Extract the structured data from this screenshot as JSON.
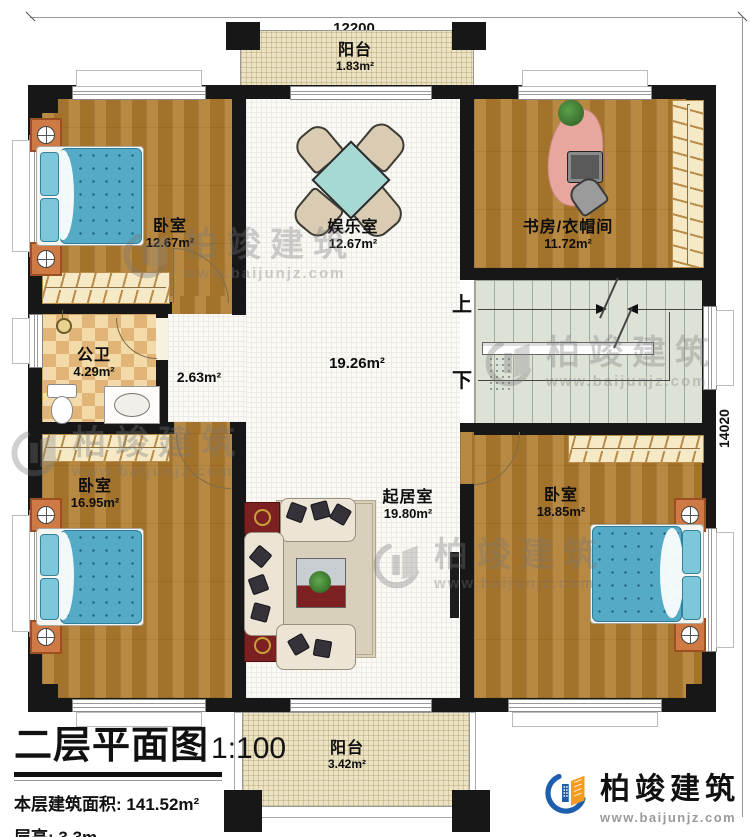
{
  "dimensions": {
    "top": "12200",
    "right": "14020"
  },
  "rooms": {
    "balcony_top": {
      "name": "阳台",
      "area": "1.83m²"
    },
    "bedroom_tl": {
      "name": "卧室",
      "area": "12.67m²"
    },
    "entertainment": {
      "name": "娱乐室",
      "area": "12.67m²"
    },
    "study": {
      "name": "书房/衣帽间",
      "area": "11.72m²"
    },
    "bathroom": {
      "name": "公卫",
      "area": "4.29m²"
    },
    "corridor": {
      "area": "2.63m²"
    },
    "hall": {
      "area": "19.26m²"
    },
    "bedroom_bl": {
      "name": "卧室",
      "area": "16.95m²"
    },
    "living": {
      "name": "起居室",
      "area": "19.80m²"
    },
    "bedroom_br": {
      "name": "卧室",
      "area": "18.85m²"
    },
    "balcony_bottom": {
      "name": "阳台",
      "area": "3.42m²"
    }
  },
  "stairs": {
    "up": "上",
    "down": "下"
  },
  "title_block": {
    "title": "二层平面图",
    "scale": "1:100",
    "area_label": "本层建筑面积:",
    "area_value": "141.52m²",
    "height_label": "层高:",
    "height_value": "3.3m"
  },
  "brand": {
    "name": "柏竣建筑",
    "site": "www.baijunjz.com"
  },
  "watermark": {
    "name": "柏竣建筑",
    "site": "www.baijunjz.com"
  },
  "colors": {
    "wall": "#171717",
    "wood_floor": "#b07c2e",
    "bed_blue": "#55abc6",
    "brand_blue": "#1d5fae",
    "brand_orange": "#f59c20"
  }
}
